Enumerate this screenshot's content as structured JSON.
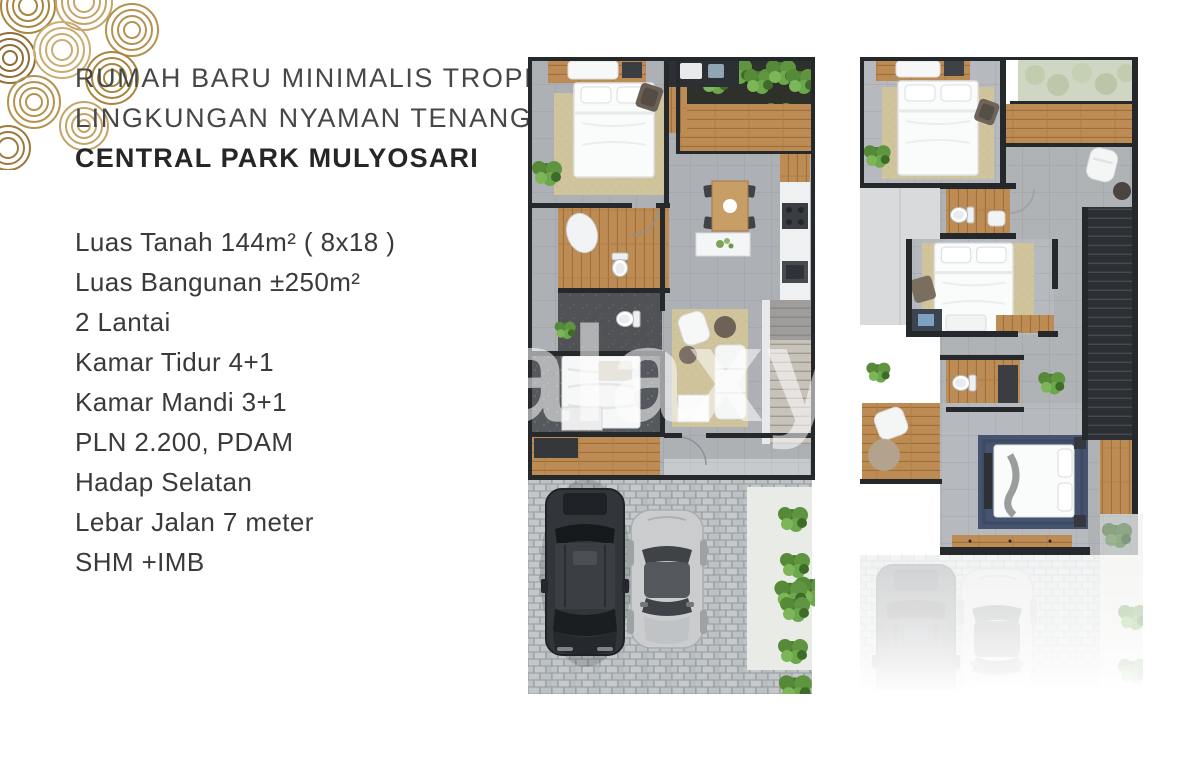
{
  "flyer": {
    "headline_line1": "RUMAH BARU MINIMALIS TROPIS",
    "headline_line2": "LINGKUNGAN NYAMAN TENANG",
    "headline_line3": "CENTRAL PARK MULYOSARI",
    "specs": [
      "Luas Tanah 144m² ( 8x18 )",
      "Luas Bangunan ±250m²",
      "2 Lantai",
      "Kamar Tidur 4+1",
      "Kamar Mandi 3+1",
      "PLN 2.200, PDAM",
      "Hadap Selatan",
      "Lebar Jalan 7 meter",
      "SHM +IMB"
    ],
    "watermark": "galaxy"
  },
  "colors": {
    "logo_gold": "#b0914e",
    "text_dark": "#3a3a3a",
    "wall": "#26292c",
    "tile_gray": "#b6babe",
    "wood": "#bd8c54",
    "rug_beige": "#cfc49c",
    "rug_navy": "#46536e",
    "plant_green": "#5f9540",
    "paving_gray": "#c2c6c9",
    "suv_black": "#32363a",
    "car_silver": "#caccce"
  }
}
